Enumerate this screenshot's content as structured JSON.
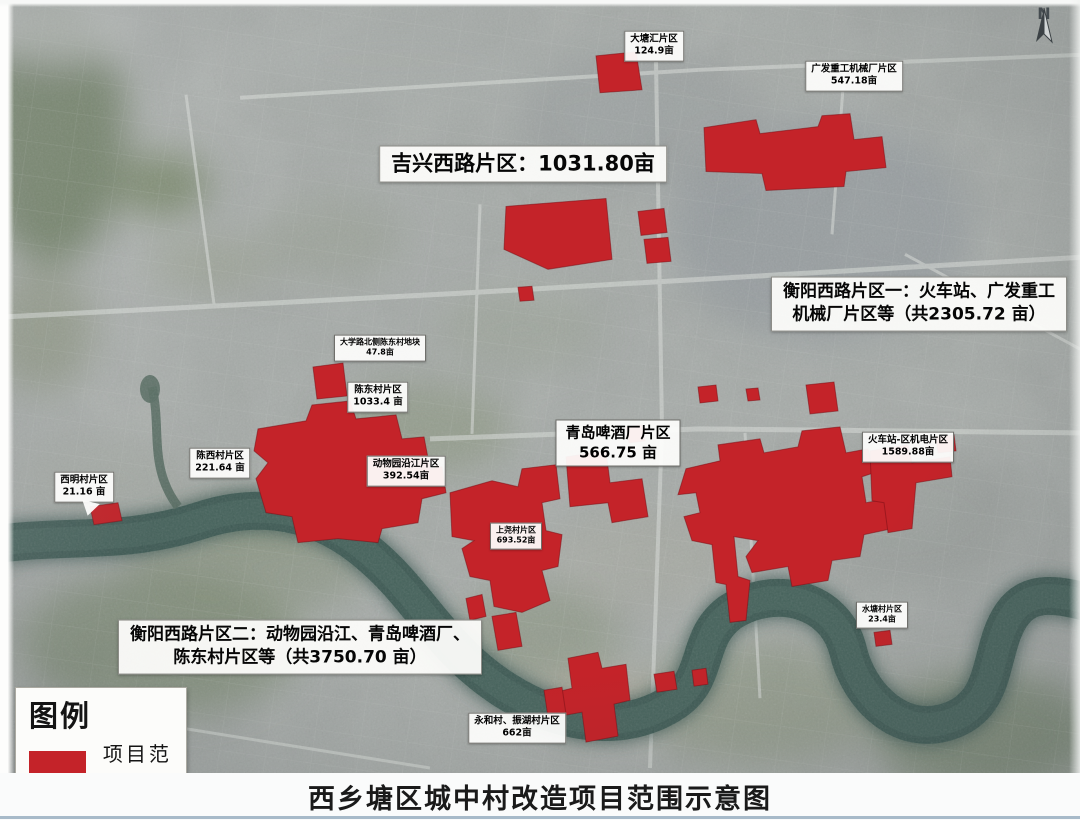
{
  "poster": {
    "title": "西乡塘区城中村改造项目范围示意图",
    "compass_label": "N"
  },
  "legend": {
    "heading": "图例",
    "item_label": "项目范围"
  },
  "colors": {
    "project_area": "#c42329",
    "river": "#3e5a54",
    "map_base": "#a6aba8"
  },
  "region_labels": [
    {
      "name": "大塘汇片区",
      "area": "124.9亩"
    },
    {
      "name": "广发重工机械厂片区",
      "area": "547.18亩"
    },
    {
      "name": "大学路北侧陈东村地块",
      "area": "47.8亩"
    },
    {
      "name": "陈东村片区",
      "area": "1033.4 亩"
    },
    {
      "name": "陈西村片区",
      "area": "221.64 亩"
    },
    {
      "name": "西明村片区",
      "area": "21.16 亩"
    },
    {
      "name": "动物园沿江片区",
      "area": "392.54亩"
    },
    {
      "name": "青岛啤酒厂片区",
      "area": "566.75 亩"
    },
    {
      "name": "上尧村片区",
      "area": "693.52亩"
    },
    {
      "name": "火车站-区机电片区",
      "area": "1589.88亩"
    },
    {
      "name": "水塘村片区",
      "area": "23.4亩"
    },
    {
      "name": "永和村、振湖村片区",
      "area": "662亩"
    }
  ],
  "district_callouts": [
    {
      "line1": "吉兴西路片区：1031.80亩",
      "line2": ""
    },
    {
      "line1": "衡阳西路片区一：火车站、广发重工",
      "line2": "机械厂片区等（共2305.72 亩）"
    },
    {
      "line1": "衡阳西路片区二：动物园沿江、青岛啤酒厂、",
      "line2": "陈东村片区等（共3750.70 亩）"
    }
  ]
}
